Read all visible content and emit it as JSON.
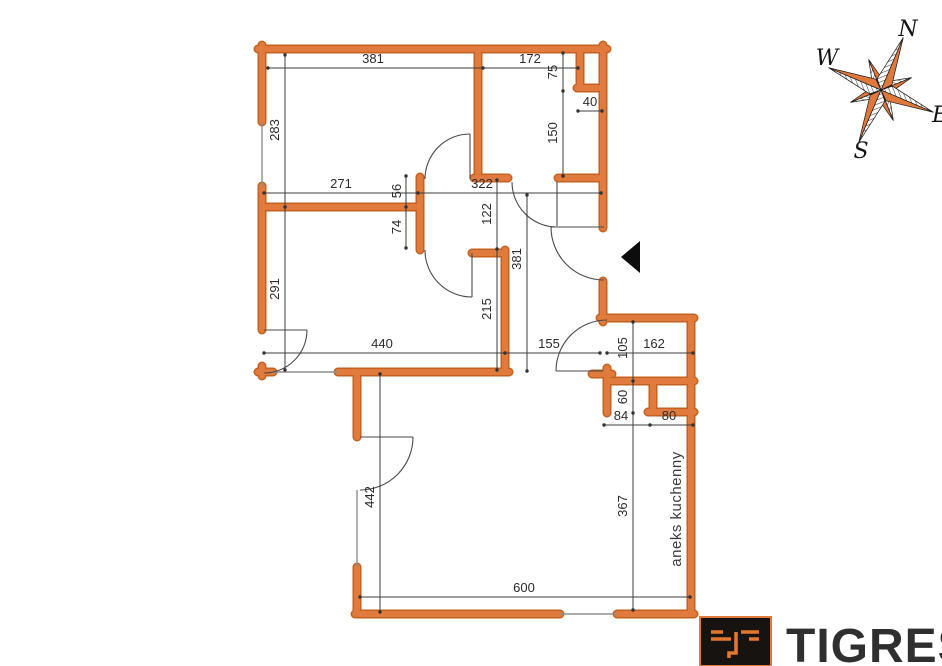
{
  "plan": {
    "dims": {
      "room1_width": "381",
      "room2_width": "172",
      "shaft_height": "75",
      "shaft_width": "40",
      "room2_height": "150",
      "room1_height": "283",
      "mid_left": "271",
      "mid_right": "322",
      "jamb_upper": "56",
      "jamb_lower": "74",
      "room3_height": "291",
      "hall_upper": "122",
      "hall_mid": "215",
      "hall_height": "381",
      "room3_width": "440",
      "hall_width": "155",
      "nook_offset": "105",
      "nook_width": "162",
      "closet_height": "60",
      "closet_left": "84",
      "closet_right": "80",
      "living_height": "442",
      "nook_height": "367",
      "living_width": "600"
    },
    "labels": {
      "kitchen_annex": "aneks kuchenny"
    }
  },
  "compass": {
    "north": "N",
    "west": "W",
    "south": "S",
    "east": "E"
  },
  "logo": {
    "brand": "TIGRES"
  },
  "colors": {
    "wall": "#e07b3d",
    "wall_outline": "#c4611f",
    "dimension_line": "#3c3c3c",
    "logo_orange": "#e2772e",
    "logo_background": "#171310"
  }
}
